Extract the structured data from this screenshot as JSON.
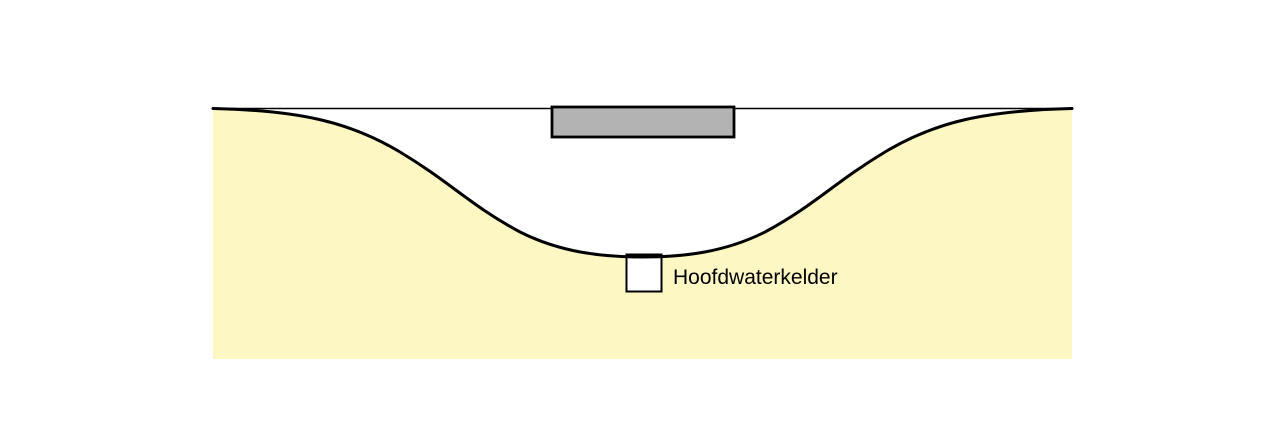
{
  "diagram": {
    "title": "cross-section of excavated basin with main water cellar",
    "labels": {
      "water_cellar": "Hoofdwaterkelder"
    },
    "colors": {
      "background": "#FFFFFF",
      "ground": "#FCF7C3",
      "structure_fill": "#B3B3B3",
      "cellar_fill": "#FFFFFF",
      "outline": "#000000"
    }
  }
}
